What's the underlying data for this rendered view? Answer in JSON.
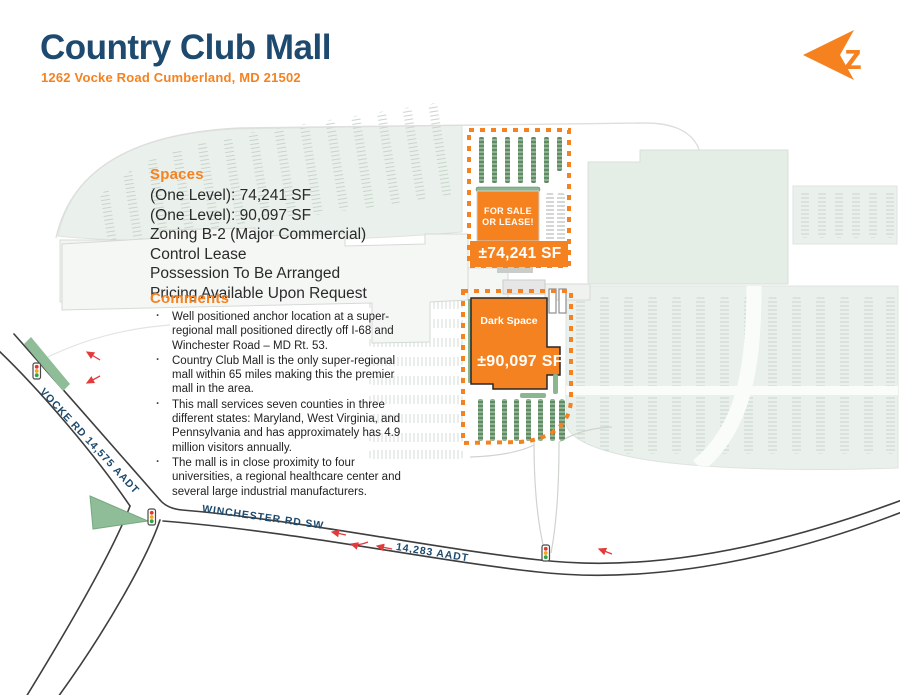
{
  "header": {
    "title": "Country Club Mall",
    "address": "1262 Vocke Road Cumberland, MD 21502",
    "logo": {
      "letter": "z",
      "icon": "arrow-left-logo",
      "color": "#f5821f"
    }
  },
  "spaces": {
    "heading": "Spaces",
    "lines": [
      "(One Level): 74,241 SF",
      "(One Level): 90,097 SF",
      "Zoning B-2 (Major Commercial)",
      "Control Lease",
      "Possession To Be Arranged",
      "Pricing Available Upon Request"
    ]
  },
  "comments": {
    "heading": "Comments",
    "bullets": [
      "Well positioned anchor location at a super-regional mall positioned directly off I-68 and Winchester Road – MD Rt. 53.",
      "Country Club Mall is the only super-regional mall within 65 miles making this the premier mall in the area.",
      "This mall services seven counties in three different states: Maryland, West Virginia, and Pennsylvania and has approximately has 4.9 million visitors annually.",
      "The mall is in close proximity to four universities, a regional healthcare center and several large industrial manufacturers."
    ]
  },
  "map": {
    "parcel_small": {
      "label": "FOR SALE OR LEASE!",
      "size": "±74,241 SF"
    },
    "parcel_large": {
      "label": "Dark Space",
      "size": "±90,097 SF"
    },
    "road_labels": [
      {
        "name": "VOCKE RD 14,575 AADT"
      },
      {
        "name": "WINCHESTER RD SW"
      },
      {
        "name": "14,283 AADT"
      }
    ],
    "icons": [
      "traffic-light-icon",
      "turn-arrow-icon"
    ]
  },
  "colors": {
    "navy": "#1d4a6e",
    "orange": "#f5821f",
    "map_green": "#8ab690",
    "field_green": "#eaf0ec",
    "road_dark": "#3e3e3e",
    "turn_arrow_red": "#e23b3b"
  }
}
